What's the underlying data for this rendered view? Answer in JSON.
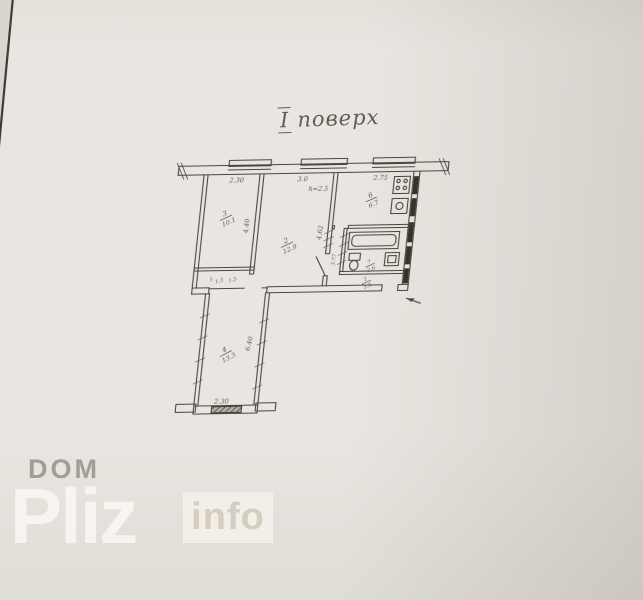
{
  "title": {
    "numeral": "І",
    "word": "поверх"
  },
  "plan": {
    "dimensions": {
      "top_left": "2.30",
      "top_middle": "3.0",
      "ceiling_height": "h=2.5",
      "top_right": "2.75",
      "room3_depth": "4.40",
      "room2_depth": "4.62",
      "lobby_depth": "3.77",
      "wing_depth": "6.40",
      "bottom": "2.30"
    },
    "rooms": {
      "room3": {
        "number": "3",
        "area": "10.1"
      },
      "room2": {
        "number": "2",
        "area": "12.9"
      },
      "kitchen": {
        "number": "6",
        "area": "6.7"
      },
      "bathroom": {
        "number": "7",
        "area": "2.6"
      },
      "hall": {
        "number": "1",
        "area": "3.3"
      },
      "closet": {
        "number": "5",
        "area": "1.3"
      },
      "closet_extra": "1.5",
      "wing_room": {
        "number": "4",
        "area": "13.3"
      }
    }
  },
  "watermark": {
    "top": "DOM",
    "main": "Pliz",
    "suffix": "info"
  },
  "colors": {
    "paper": "#e9e6e1",
    "ink": "#4a453f",
    "vent_block": "#35312b",
    "watermark_gray": "#a19e98"
  }
}
